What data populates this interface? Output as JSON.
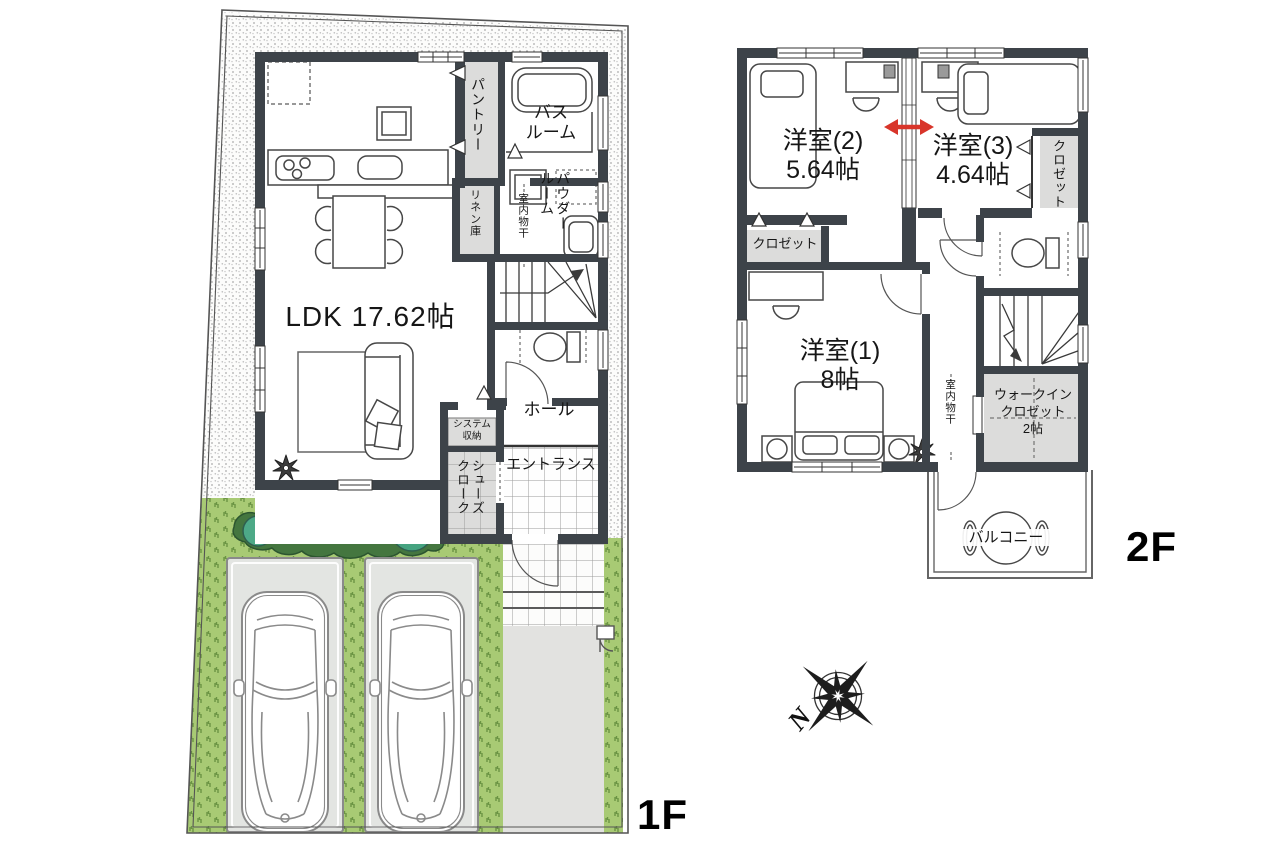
{
  "colors": {
    "wall": "#3d4349",
    "room_gray": "#dcdcdb",
    "accent_red": "#d8352a",
    "lawn_green": "#a8ca74",
    "lawn_mark_green": "#6b9444",
    "hedge_green": "#44763f",
    "bush_green": "#4da987",
    "pad_gray": "#e3e5e2",
    "drive_gray": "#e2e2e0"
  },
  "floor1": {
    "label": "1F",
    "ldk": "LDK 17.62帖",
    "pantry": "パントリー",
    "bathroom": "バス\nルーム",
    "linen": "リネン庫",
    "powder_room": "パウダー\nルーム",
    "indoor_drying": "室内物干",
    "hall": "ホール",
    "system_storage": "システム\n収納",
    "shoes_closet": "シューズ\nクローク",
    "entrance": "エントランス"
  },
  "floor2": {
    "label": "2F",
    "room2_name": "洋室(2)",
    "room2_size": "5.64帖",
    "room3_name": "洋室(3)",
    "room3_size": "4.64帖",
    "room1_name": "洋室(1)",
    "room1_size": "8帖",
    "closet_left": "クロゼット",
    "closet_right": "クロゼット",
    "walk_in_closet": "ウォークイン\nクロゼット\n2帖",
    "indoor_drying": "室内物干",
    "balcony": "バルコニー"
  },
  "compass": {
    "north": "N"
  }
}
